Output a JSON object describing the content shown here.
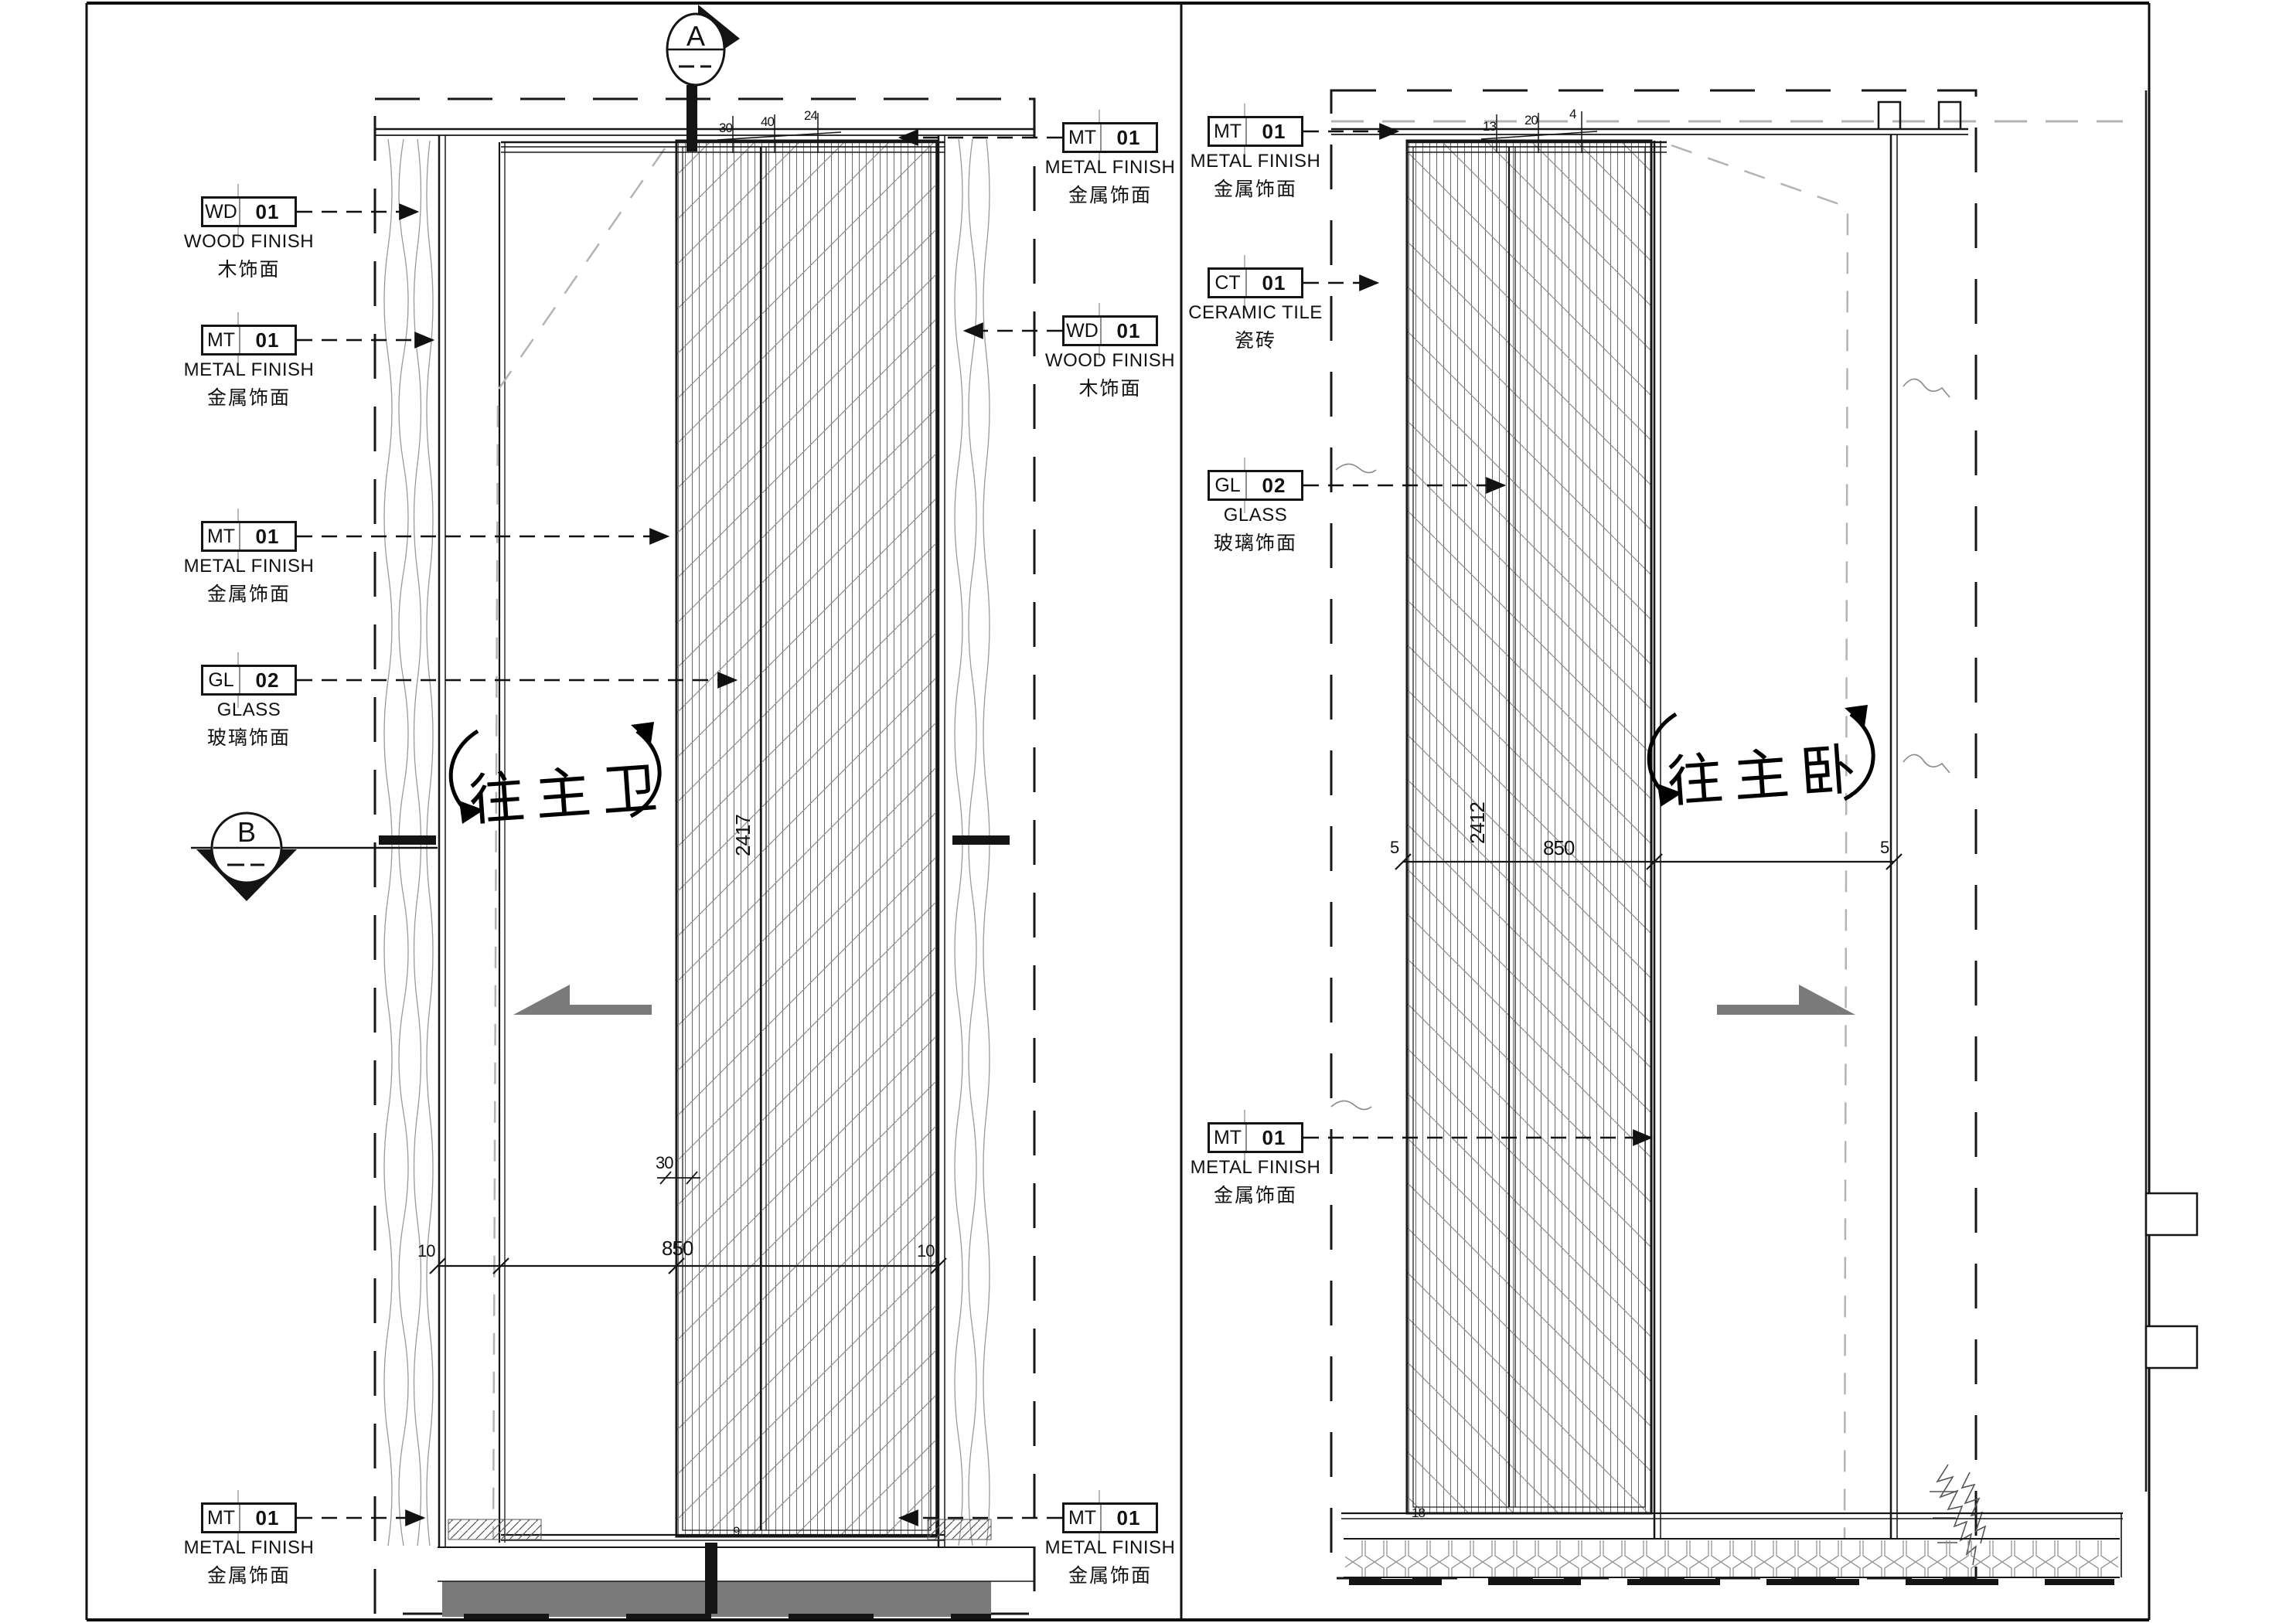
{
  "drawing": {
    "section_markers": {
      "a": "A",
      "b": "B"
    },
    "notes": {
      "to_master_bath": "往主卫",
      "to_master_bedroom": "往主卧"
    },
    "labels": [
      {
        "code": "WD",
        "num": "01",
        "en": "WOOD FINISH",
        "zh": "木饰面"
      },
      {
        "code": "MT",
        "num": "01",
        "en": "METAL FINISH",
        "zh": "金属饰面"
      },
      {
        "code": "MT",
        "num": "01",
        "en": "METAL FINISH",
        "zh": "金属饰面"
      },
      {
        "code": "GL",
        "num": "02",
        "en": "GLASS",
        "zh": "玻璃饰面"
      },
      {
        "code": "MT",
        "num": "01",
        "en": "METAL FINISH",
        "zh": "金属饰面"
      },
      {
        "code": "MT",
        "num": "01",
        "en": "METAL FINISH",
        "zh": "金属饰面"
      },
      {
        "code": "WD",
        "num": "01",
        "en": "WOOD FINISH",
        "zh": "木饰面"
      },
      {
        "code": "MT",
        "num": "01",
        "en": "METAL FINISH",
        "zh": "金属饰面"
      },
      {
        "code": "MT",
        "num": "01",
        "en": "METAL FINISH",
        "zh": "金属饰面"
      },
      {
        "code": "CT",
        "num": "01",
        "en": "CERAMIC TILE",
        "zh": "瓷砖"
      },
      {
        "code": "GL",
        "num": "02",
        "en": "GLASS",
        "zh": "玻璃饰面"
      },
      {
        "code": "MT",
        "num": "01",
        "en": "METAL FINISH",
        "zh": "金属饰面"
      }
    ],
    "dimensions": {
      "left_sheet": {
        "door_height": "2417",
        "door_width": "850",
        "gap_left": "10",
        "gap_right": "10",
        "track": "30",
        "top_stack": [
          "30",
          "40",
          "24"
        ],
        "bottom_stack": [
          "9"
        ]
      },
      "right_sheet": {
        "door_height": "2412",
        "door_width": "850",
        "end_left": "5",
        "end_right": "5",
        "top_stack": [
          "13",
          "20",
          "4"
        ],
        "bottom_stack": [
          "18"
        ]
      }
    },
    "colors": {
      "line": "#161616",
      "floor_band": "#7a7a7a",
      "slide_arrow": "#7a7a7a",
      "phantom": "#b3b3b3",
      "hatch": "#6a6a6a"
    }
  }
}
